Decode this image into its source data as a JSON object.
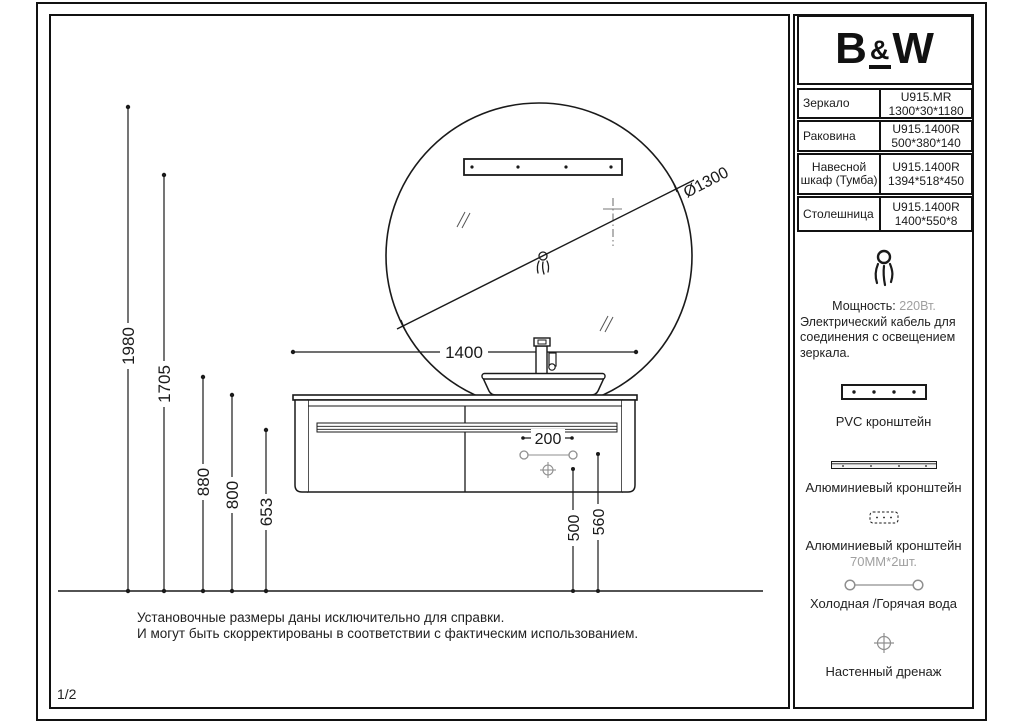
{
  "page": {
    "number": "1/2"
  },
  "logo": {
    "b": "B",
    "amp": "&",
    "w": "W"
  },
  "table": {
    "rows": [
      {
        "label": "Зеркало",
        "code": "U915.MR",
        "size": "1300*30*1180"
      },
      {
        "label": "Раковина",
        "code": "U915.1400R",
        "size": "500*380*140"
      },
      {
        "label": "Навесной шкаф (Тумба)",
        "code": "U915.1400R",
        "size": "1394*518*450"
      },
      {
        "label": "Столешница",
        "code": "U915.1400R",
        "size": "1400*550*8"
      }
    ]
  },
  "power": {
    "label": "Мощность:",
    "value": "220Вт.",
    "line1": "Электрический кабель для",
    "line2": "соединения с освещением",
    "line3": "зеркала."
  },
  "legend": {
    "pvc": "PVC кронштейн",
    "alu1": "Алюминиевый кронштейн",
    "alu2": "Алюминиевый кронштейн",
    "alu2_qty": "70MM*2шт.",
    "water": "Холодная /Горячая вода",
    "drain": "Настенный дренаж"
  },
  "note": {
    "line1": "Установочные размеры даны исключительно для справки.",
    "line2": "И могут быть скорректированы в соответствии с фактическим использованием."
  },
  "dims": {
    "h1980": "1980",
    "h1705": "1705",
    "h880": "880",
    "h800": "800",
    "h653": "653",
    "w1400": "1400",
    "s200": "200",
    "d500": "500",
    "d560": "560",
    "dia": "Ø1300"
  },
  "colors": {
    "line": "#1a1a1a",
    "gray": "#8f8f8f",
    "muted": "#a0a0a0"
  }
}
